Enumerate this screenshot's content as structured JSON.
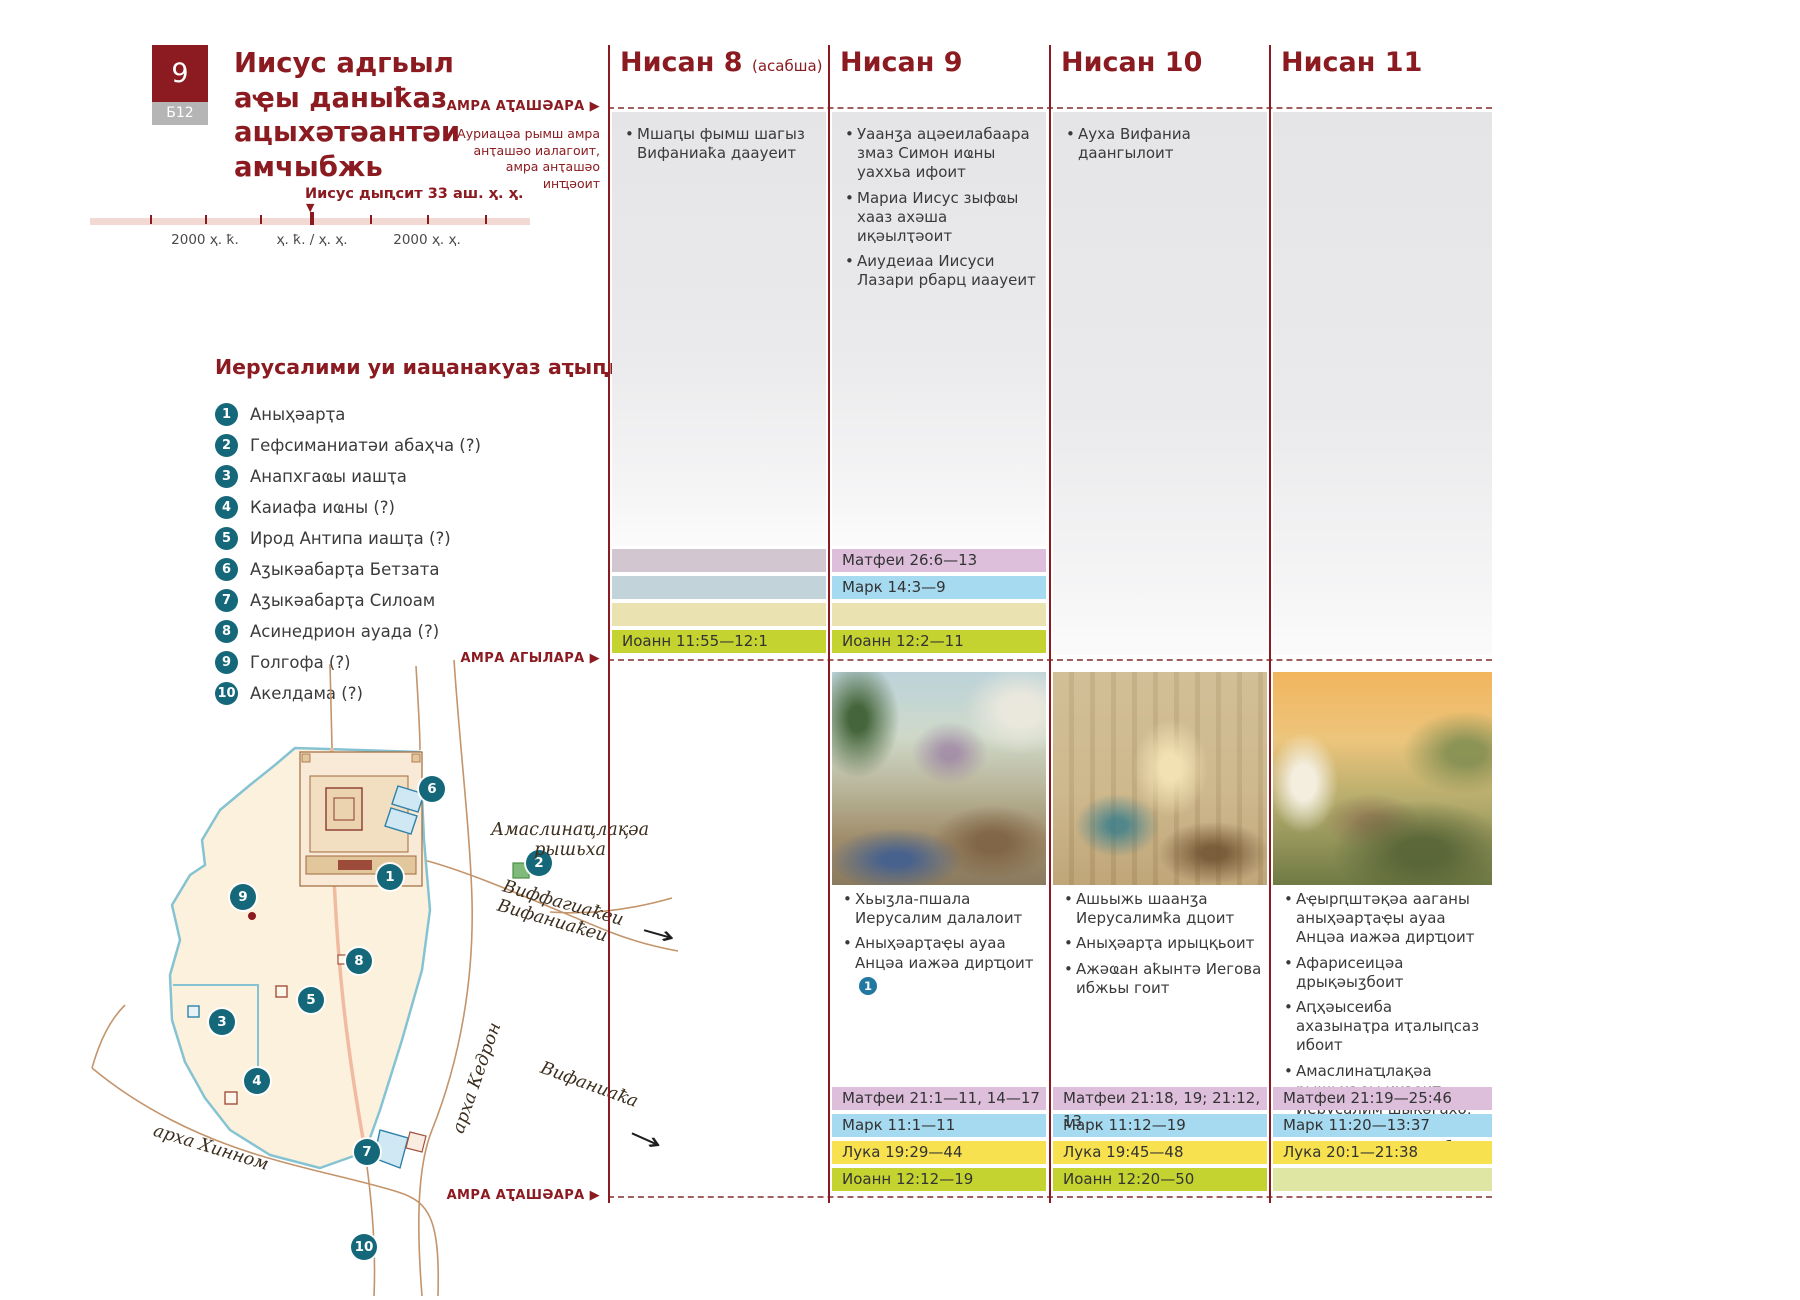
{
  "page": {
    "badge_number": "9",
    "badge_code": "Б12",
    "title": "Иисус адгьыл аҿы даныҟаз ацыхәтәантәи амчыбжь"
  },
  "timeline": {
    "marker_label": "Иисус дыԥсит 33 аш. ҳ. ҳ.",
    "marker_glyph": "▼",
    "tick_left": "2000 ҳ. ҟ.",
    "tick_center": "ҳ. ҟ. / ҳ. ҳ.",
    "tick_right": "2000 ҳ. ҳ."
  },
  "sun": {
    "arrow": "▶",
    "sunset_top": "АМРА АҬАШӘАРА",
    "sunset_note": "Ауриацәа рымш амра анҭашәо иалагоит, амра анҭашәо инҵәоит",
    "sunrise": "АМРА АГЫЛАРА",
    "sunset_bottom": "АМРА АҬАШӘАРА"
  },
  "places": {
    "heading": "Иерусалими уи иацанакуаз аҭыԥқәеи",
    "items": [
      {
        "num": "1",
        "label": "Аныҳәарҭа"
      },
      {
        "num": "2",
        "label": "Гефсиманиатәи абаҳча (?)"
      },
      {
        "num": "3",
        "label": "Анапхгаҩы иашҭа"
      },
      {
        "num": "4",
        "label": "Каиафа иҩны (?)"
      },
      {
        "num": "5",
        "label": "Ирод Антипа иашҭа (?)"
      },
      {
        "num": "6",
        "label": "Аӡыкәабарҭа Бетзата"
      },
      {
        "num": "7",
        "label": "Аӡыкәабарҭа Силоам"
      },
      {
        "num": "8",
        "label": "Асинедрион ауада (?)"
      },
      {
        "num": "9",
        "label": "Голгофа (?)"
      },
      {
        "num": "10",
        "label": "Акелдама (?)"
      }
    ]
  },
  "map": {
    "markers": [
      "1",
      "2",
      "3",
      "4",
      "5",
      "6",
      "7",
      "8",
      "9",
      "10"
    ],
    "labels": {
      "olives_line1": "Амаслинаҵлақәа",
      "olives_line2": "рышьха",
      "bethphage": "Виффагиаҟеи",
      "bethany_road": "Вифаниаҟеи",
      "bethany": "Вифаниаҟа",
      "kidron": "арха Кедрон",
      "hinnom": "арха Хинном",
      "arrow": "→"
    }
  },
  "columns": [
    {
      "title": "Нисан 8",
      "subtitle": "(асабша)",
      "top_events": [
        {
          "text": "Мшаԥы фымш шагыз Вифаниаҟа даауеит"
        }
      ],
      "mid_refs": [
        {
          "text": "",
          "muted": true
        },
        {
          "text": "",
          "muted": true
        },
        {
          "text": "",
          "muted": true
        },
        {
          "text": "Иоанн 11:55—12:1",
          "muted": false
        }
      ],
      "bottom_events": [],
      "bottom_refs": []
    },
    {
      "title": "Нисан 9",
      "top_events": [
        {
          "text": "Уаанӡа ацәеилабаара змаз Симон иҩны уаххьа ифоит"
        },
        {
          "text": "Мариа Иисус зыфҩы хааз ахәша иқәылҭәоит"
        },
        {
          "text": "Аиудеиаа Иисуси Лазари рбарц иаауеит"
        }
      ],
      "mid_refs": [
        {
          "text": "Матфеи 26:6—13",
          "muted": false
        },
        {
          "text": "Марк 14:3—9",
          "muted": false
        },
        {
          "text": "",
          "muted": true
        },
        {
          "text": "Иоанн 12:2—11",
          "muted": false
        }
      ],
      "bottom_events": [
        {
          "text": "Хьыӡла-пшала Иерусалим далалоит"
        },
        {
          "text": "Аныҳәарҭаҿы ауаа Анцәа иажәа дирҵоит",
          "ref": "1"
        }
      ],
      "bottom_refs": [
        {
          "text": "Матфеи 21:1—11, 14—17",
          "muted": false
        },
        {
          "text": "Марк 11:1—11",
          "muted": false
        },
        {
          "text": "Лука 19:29—44",
          "muted": false
        },
        {
          "text": "Иоанн 12:12—19",
          "muted": false
        }
      ]
    },
    {
      "title": "Нисан 10",
      "top_events": [
        {
          "text": "Ауха Вифаниа даангылоит"
        }
      ],
      "mid_refs": [],
      "bottom_events": [
        {
          "text": "Ашьыжь шаанӡа Иерусалимҟа дцоит"
        },
        {
          "text": "Аныҳәарҭа ирыцқьоит"
        },
        {
          "text": "Ажәҩан аҟынтә Иегова ибжьы гоит"
        }
      ],
      "bottom_refs": [
        {
          "text": "Матфеи 21:18, 19; 21:12, 13",
          "muted": false
        },
        {
          "text": "Марк 11:12—19",
          "muted": false
        },
        {
          "text": "Лука 19:45—48",
          "muted": false
        },
        {
          "text": "Иоанн 12:20—50",
          "muted": false
        }
      ]
    },
    {
      "title": "Нисан 11",
      "top_events": [],
      "mid_refs": [],
      "bottom_events": [
        {
          "text": "Аҿырԥштәқәа ааганы аныҳәарҭаҿы ауаа Анцәа иажәа дирҵоит"
        },
        {
          "text": "Афарисеицәа дрықәыӡбоит"
        },
        {
          "text": "Аԥҳәысеиба ахазынаҭра иҭалыԥсаз ибоит"
        },
        {
          "text": "Амаслинаҵлақәа рышьхаҿы иҳәоит Иерусалим шықәгахо, насгьы иарбан дыргоу дшыхынҳәыз узырбо"
        }
      ],
      "bottom_refs": [
        {
          "text": "Матфеи 21:19—25:46",
          "muted": false
        },
        {
          "text": "Марк 11:20—13:37",
          "muted": false
        },
        {
          "text": "Лука 20:1—21:38",
          "muted": false
        },
        {
          "text": "",
          "muted": true
        }
      ]
    }
  ],
  "colors": {
    "accent_red": "#8b1b20",
    "teal_badge": "#14687a",
    "matthew_band": "#ddbfdc",
    "mark_band": "#a5daf0",
    "luke_band": "#f7e14e",
    "john_band": "#c4d32f"
  }
}
